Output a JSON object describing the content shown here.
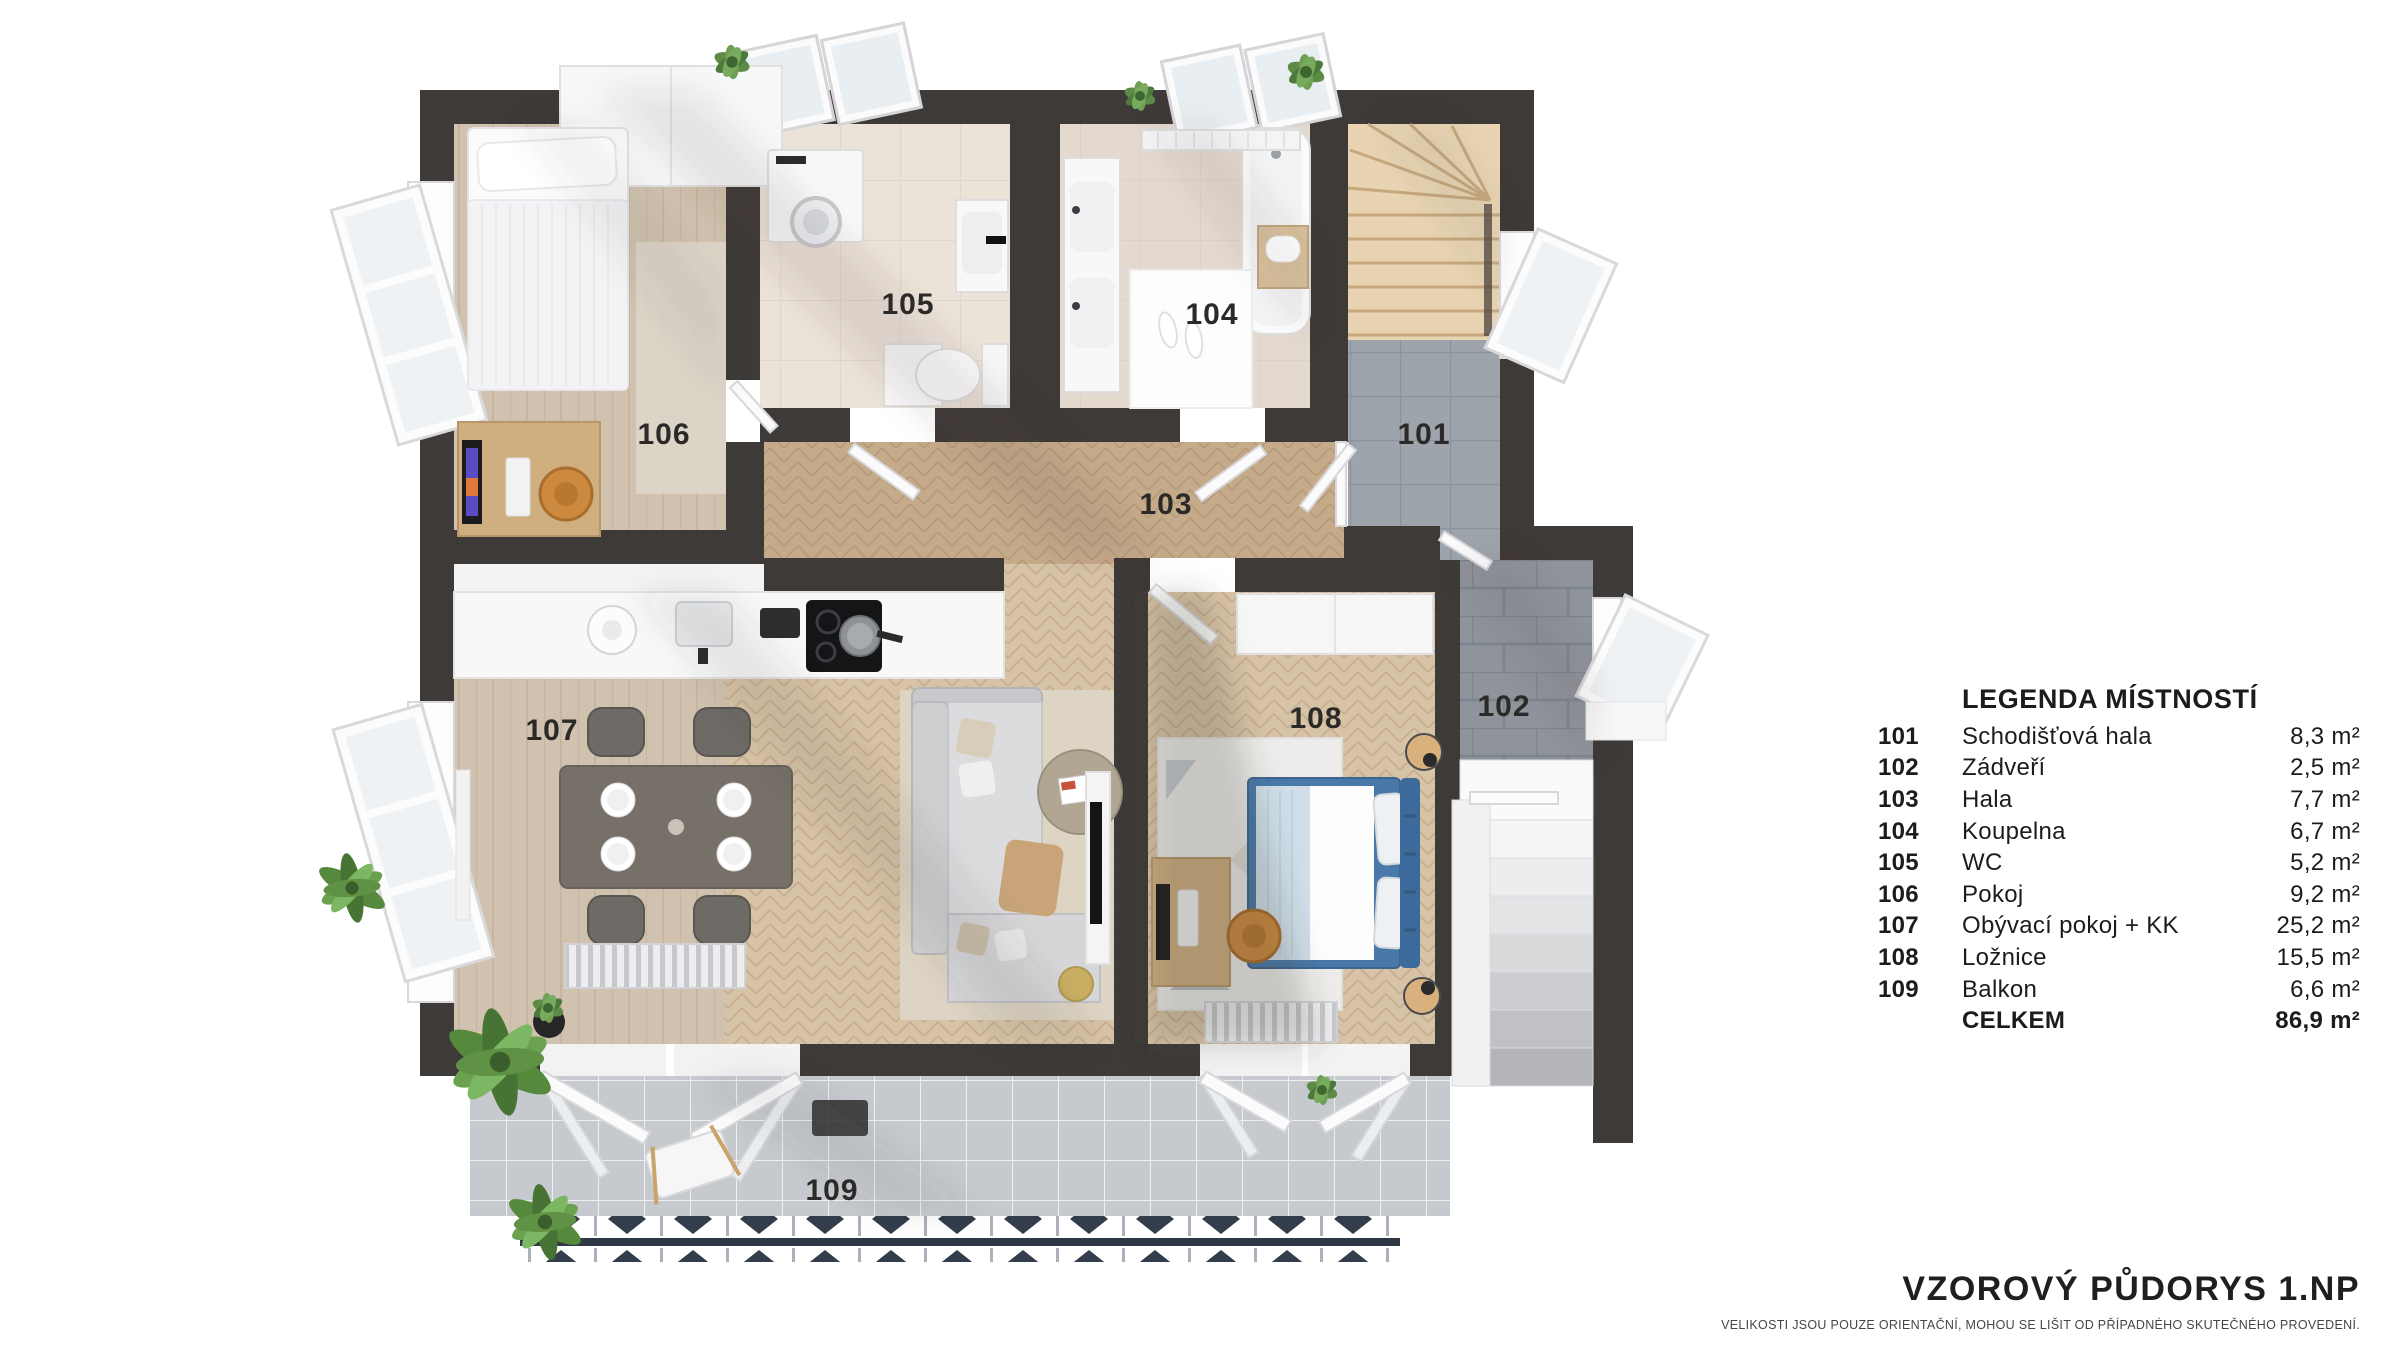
{
  "plan": {
    "room_labels": {
      "r101": "101",
      "r102": "102",
      "r103": "103",
      "r104": "104",
      "r105": "105",
      "r106": "106",
      "r107": "107",
      "r108": "108",
      "r109": "109"
    }
  },
  "legend": {
    "title": "LEGENDA MÍSTNOSTÍ",
    "rows": [
      {
        "number": "101",
        "name": "Schodišťová hala",
        "area": "8,3 m²"
      },
      {
        "number": "102",
        "name": "Zádveří",
        "area": "2,5 m²"
      },
      {
        "number": "103",
        "name": "Hala",
        "area": "7,7 m²"
      },
      {
        "number": "104",
        "name": "Koupelna",
        "area": "6,7 m²"
      },
      {
        "number": "105",
        "name": "WC",
        "area": "5,2 m²"
      },
      {
        "number": "106",
        "name": "Pokoj",
        "area": "9,2 m²"
      },
      {
        "number": "107",
        "name": "Obývací pokoj + KK",
        "area": "25,2 m²"
      },
      {
        "number": "108",
        "name": "Ložnice",
        "area": "15,5 m²"
      },
      {
        "number": "109",
        "name": "Balkon",
        "area": "6,6 m²"
      },
      {
        "number": "",
        "name": "CELKEM",
        "area": "86,9 m²"
      }
    ]
  },
  "footer": {
    "title": "VZOROVÝ PŮDORYS 1.NP",
    "disclaimer": "VELIKOSTI JSOU POUZE ORIENTAČNÍ, MOHOU SE LIŠIT OD PŘÍPADNÉHO SKUTEČNÉHO PROVEDENÍ."
  },
  "colors": {
    "wall": "#3e3a38",
    "wood_floor": "#c9af90",
    "hall_tile": "#9da4ac",
    "bath_tile": "#ebe2d8",
    "balcony_tile": "#c6c9cd",
    "bed_accent_blue": "#4879a9",
    "chair_accent_orange": "#cd8a3e",
    "plant_green": "#5d8a45"
  }
}
